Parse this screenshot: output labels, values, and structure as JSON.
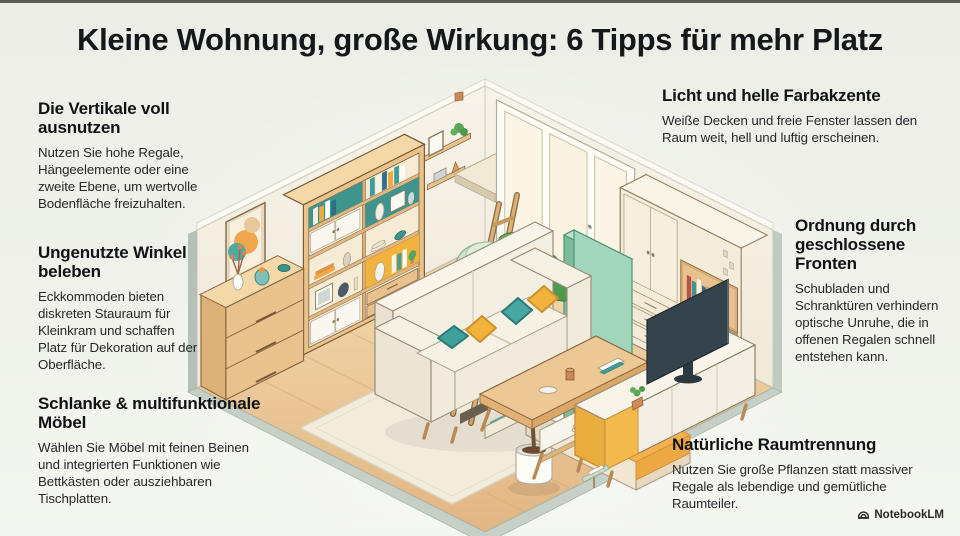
{
  "title": "Kleine Wohnung, große Wirkung: 6 Tipps für mehr Platz",
  "tips": [
    {
      "id": "vertical",
      "heading": "Die Vertikale voll ausnutzen",
      "body": "Nutzen Sie hohe Regale, Hängeelemente oder eine zweite Ebene, um wertvolle Bodenfläche freizuhalten."
    },
    {
      "id": "corners",
      "heading": "Ungenutzte Winkel beleben",
      "body": "Eckkommoden bieten diskreten Stauraum für Kleinkram und schaffen Platz für Dekoration auf der Oberfläche."
    },
    {
      "id": "slim-furniture",
      "heading": "Schlanke & multifunktionale Möbel",
      "body": "Wählen Sie Möbel mit feinen Beinen und integrierten Funktionen wie Bettkästen oder ausziehbaren Tischplatten."
    },
    {
      "id": "light",
      "heading": "Licht und helle Farbakzente",
      "body": "Weiße Decken und freie Fenster lassen den Raum weit, hell und luftig erscheinen."
    },
    {
      "id": "closed-fronts",
      "heading": "Ordnung durch geschlossene Fronten",
      "body": "Schubladen und Schranktüren verhindern optische Unruhe, die in offenen Regalen schnell entstehen kann."
    },
    {
      "id": "room-divider",
      "heading": "Natürliche Raumtrennung",
      "body": "Nutzen Sie große Pflanzen statt massiver Regale als lebendige und gemütliche Raumteiler."
    }
  ],
  "watermark": {
    "label": "NotebookLM"
  },
  "illustration": {
    "description": "Isometric cutaway of a small furnished one-room apartment",
    "depicted_objects": [
      "tall-bookshelf",
      "framed-wall-art",
      "corner-dresser-with-vases",
      "wall-shelves",
      "loft-platform",
      "wooden-ladder",
      "beanbag-chair",
      "floor-to-ceiling-windows",
      "sofa-with-storage-drawer",
      "throw-pillows",
      "area-rug",
      "coffee-table",
      "tv-sideboard",
      "television",
      "wardrobe-with-desk-nook",
      "bed-with-orange-blanket",
      "teal-room-divider-panel",
      "large-potted-plant"
    ],
    "colors": {
      "background": "#eff0ea",
      "accent_teal": "#3f9e9b",
      "accent_yellow": "#f2b33e",
      "wood": "#e9c28c",
      "wall": "#f6f2e9",
      "floor_wood": "#e8c596",
      "plant_green": "#4e9b50",
      "divider_green": "#a2d6bc",
      "platform_edge": "#c6d0c7"
    }
  }
}
